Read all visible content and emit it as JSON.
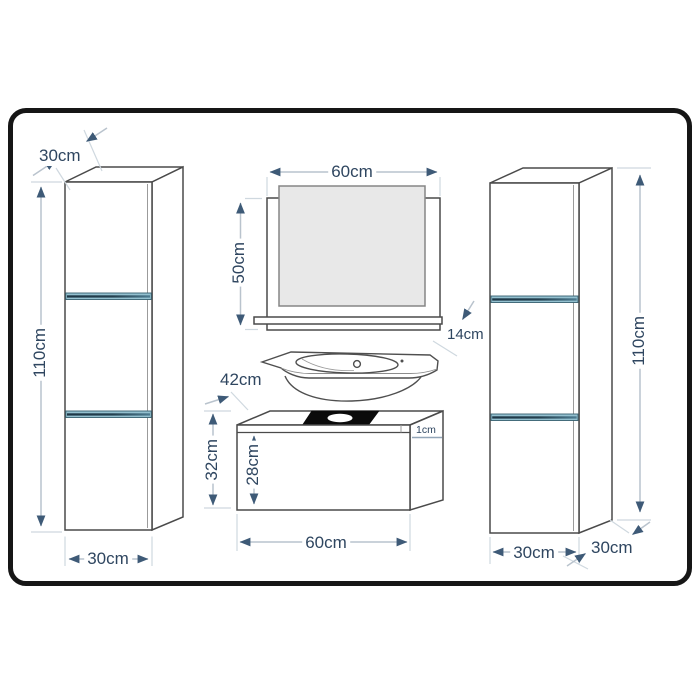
{
  "dimensions": {
    "left_cabinet": {
      "depth_top": "30cm",
      "height": "110cm",
      "width": "30cm"
    },
    "mirror": {
      "width": "60cm",
      "height": "50cm",
      "shelf_depth": "14cm"
    },
    "washbasin": {
      "depth": "42cm"
    },
    "vanity_cabinet": {
      "height": "32cm",
      "drawer_front_height": "28cm",
      "top_panel_thickness": "1cm",
      "width": "60cm"
    },
    "right_cabinet": {
      "height": "110cm",
      "width": "30cm",
      "depth": "30cm"
    }
  },
  "colors": {
    "background": "#ffffff",
    "border": "#161616",
    "line_art": "#4a4a4a",
    "dimension_line": "#b9c3cd",
    "extension_line": "#cfd8df",
    "dimension_text": "#2f4660",
    "arrowhead": "#3e5a77",
    "divider_light": "#93c0cf",
    "divider_bar": "#1d3646",
    "mirror_glass": "#e8e8e8",
    "sink_cutout": "#0b0b0b"
  }
}
